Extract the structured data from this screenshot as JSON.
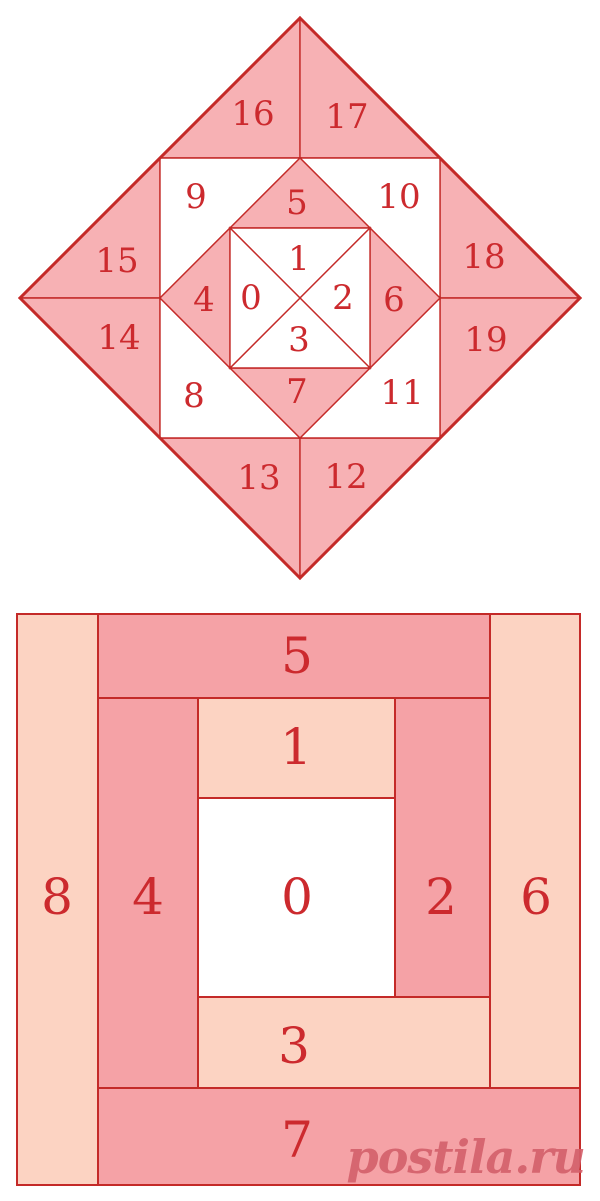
{
  "page": {
    "background": "#ffffff",
    "width": 600,
    "height": 1201
  },
  "palette": {
    "pink": "#f7b1b4",
    "pink2": "#f5a2a6",
    "peach": "#fcd3c2",
    "white": "#ffffff",
    "outline": "#c42a28",
    "number": "#cc2a2e",
    "watermark": "#d4616c"
  },
  "watermark": {
    "text": "postila.ru"
  },
  "blocks": [
    {
      "name": "square-in-square-block",
      "label_size": 34,
      "stroke_width": 1.4,
      "outline": {
        "points": "300,18 580,298 300,578 20,298",
        "width": 3
      },
      "pieces": [
        {
          "label": "16",
          "fill": "pink",
          "points": "300,18 160,158 300,158",
          "label_xy": [
            253,
            114
          ]
        },
        {
          "label": "17",
          "fill": "pink",
          "points": "300,18 440,158 300,158",
          "label_xy": [
            347,
            117
          ]
        },
        {
          "label": "15",
          "fill": "pink",
          "points": "20,298 160,158 160,298",
          "label_xy": [
            117,
            261
          ]
        },
        {
          "label": "14",
          "fill": "pink",
          "points": "20,298 160,298 160,438",
          "label_xy": [
            119,
            338
          ]
        },
        {
          "label": "18",
          "fill": "pink",
          "points": "580,298 440,158 440,298",
          "label_xy": [
            484,
            257
          ]
        },
        {
          "label": "19",
          "fill": "pink",
          "points": "580,298 440,298 440,438",
          "label_xy": [
            486,
            340
          ]
        },
        {
          "label": "13",
          "fill": "pink",
          "points": "300,578 160,438 300,438",
          "label_xy": [
            259,
            478
          ]
        },
        {
          "label": "12",
          "fill": "pink",
          "points": "300,578 300,438 440,438",
          "label_xy": [
            346,
            477
          ]
        },
        {
          "label": "9",
          "fill": "white",
          "points": "160,158 300,158 160,298",
          "label_xy": [
            196,
            197
          ]
        },
        {
          "label": "10",
          "fill": "white",
          "points": "440,158 300,158 440,298",
          "label_xy": [
            399,
            197
          ]
        },
        {
          "label": "8",
          "fill": "white",
          "points": "160,438 160,298 300,438",
          "label_xy": [
            194,
            396
          ]
        },
        {
          "label": "11",
          "fill": "white",
          "points": "440,438 440,298 300,438",
          "label_xy": [
            402,
            393
          ]
        },
        {
          "label": "5",
          "fill": "pink",
          "points": "300,158 230,228 370,228",
          "label_xy": [
            297,
            203
          ]
        },
        {
          "label": "6",
          "fill": "pink",
          "points": "440,298 370,228 370,368",
          "label_xy": [
            394,
            300
          ]
        },
        {
          "label": "7",
          "fill": "pink",
          "points": "300,438 230,368 370,368",
          "label_xy": [
            297,
            392
          ]
        },
        {
          "label": "4",
          "fill": "pink",
          "points": "160,298 230,228 230,368",
          "label_xy": [
            204,
            300
          ]
        },
        {
          "label": "1",
          "fill": "white",
          "points": "230,228 370,228 300,298",
          "label_xy": [
            299,
            259
          ]
        },
        {
          "label": "2",
          "fill": "white",
          "points": "370,228 370,368 300,298",
          "label_xy": [
            343,
            298
          ]
        },
        {
          "label": "3",
          "fill": "white",
          "points": "230,368 370,368 300,298",
          "label_xy": [
            299,
            340
          ]
        },
        {
          "label": "0",
          "fill": "white",
          "points": "230,228 230,368 300,298",
          "label_xy": [
            251,
            298
          ]
        }
      ]
    },
    {
      "name": "log-cabin-block",
      "label_size": 50,
      "stroke_width": 2,
      "pieces": [
        {
          "label": "8",
          "fill": "peach",
          "rect": [
            17,
            614,
            81,
            571
          ],
          "label_xy": [
            57,
            897
          ]
        },
        {
          "label": "5",
          "fill": "pink2",
          "rect": [
            98,
            614,
            392,
            84
          ],
          "label_xy": [
            297,
            656
          ]
        },
        {
          "label": "6",
          "fill": "peach",
          "rect": [
            490,
            614,
            90,
            474
          ],
          "label_xy": [
            536,
            897
          ]
        },
        {
          "label": "7",
          "fill": "pink2",
          "rect": [
            98,
            1088,
            482,
            97
          ],
          "label_xy": [
            297,
            1140
          ]
        },
        {
          "label": "4",
          "fill": "pink2",
          "rect": [
            98,
            698,
            100,
            390
          ],
          "label_xy": [
            148,
            897
          ]
        },
        {
          "label": "1",
          "fill": "peach",
          "rect": [
            198,
            698,
            197,
            100
          ],
          "label_xy": [
            296,
            747
          ]
        },
        {
          "label": "2",
          "fill": "pink2",
          "rect": [
            395,
            698,
            95,
            299
          ],
          "label_xy": [
            441,
            897
          ]
        },
        {
          "label": "3",
          "fill": "peach",
          "rect": [
            198,
            997,
            292,
            91
          ],
          "label_xy": [
            294,
            1046
          ]
        },
        {
          "label": "0",
          "fill": "white",
          "rect": [
            198,
            798,
            197,
            199
          ],
          "label_xy": [
            297,
            897
          ]
        }
      ]
    }
  ]
}
